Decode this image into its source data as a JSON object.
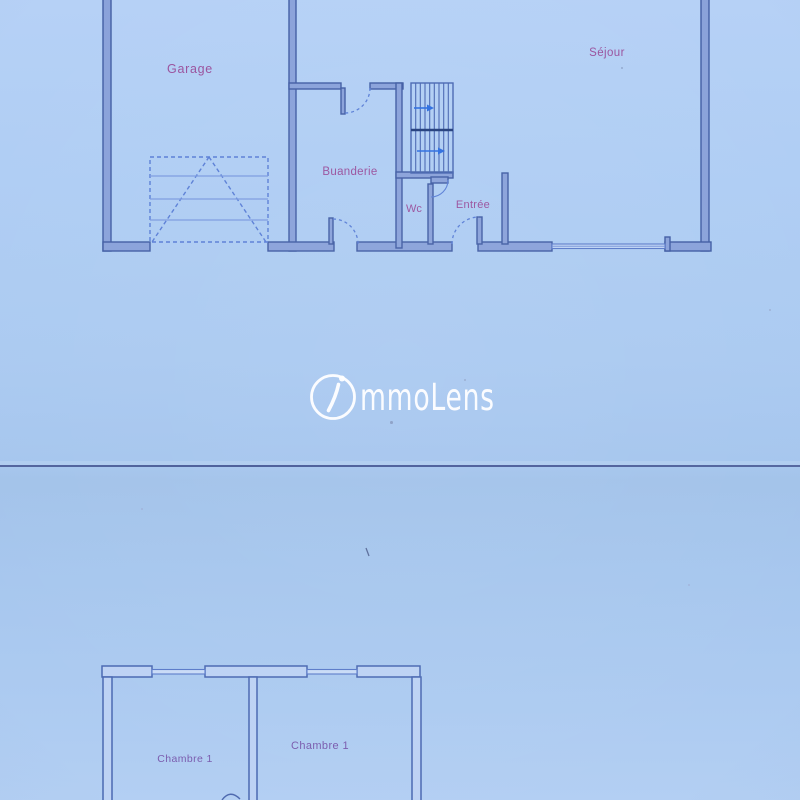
{
  "brand": {
    "name": "immoLens",
    "name_i": "i",
    "name_rest": "mmoLens"
  },
  "ground_floor": {
    "rooms": [
      {
        "label": "Garage"
      },
      {
        "label": "Séjour"
      },
      {
        "label": "Buanderie"
      },
      {
        "label": "Wc"
      },
      {
        "label": "Entrée"
      }
    ]
  },
  "upper_floor": {
    "rooms": [
      {
        "label": "Chambre 1"
      },
      {
        "label": "Chambre 1"
      }
    ]
  },
  "colors": {
    "background": "#adcbf1",
    "wall_ground_fill": "#8aa2da",
    "wall_ground_outline": "#425ea4",
    "wall_upper_fill": "#bdd2f4",
    "wall_upper_outline": "#4b69b2",
    "room_label": "#9a529d",
    "chambre_label": "#7a5cae",
    "stair_arrow": "#2f6fe0",
    "watermark": "#ffffff",
    "divider_line": "#4d5f99"
  }
}
